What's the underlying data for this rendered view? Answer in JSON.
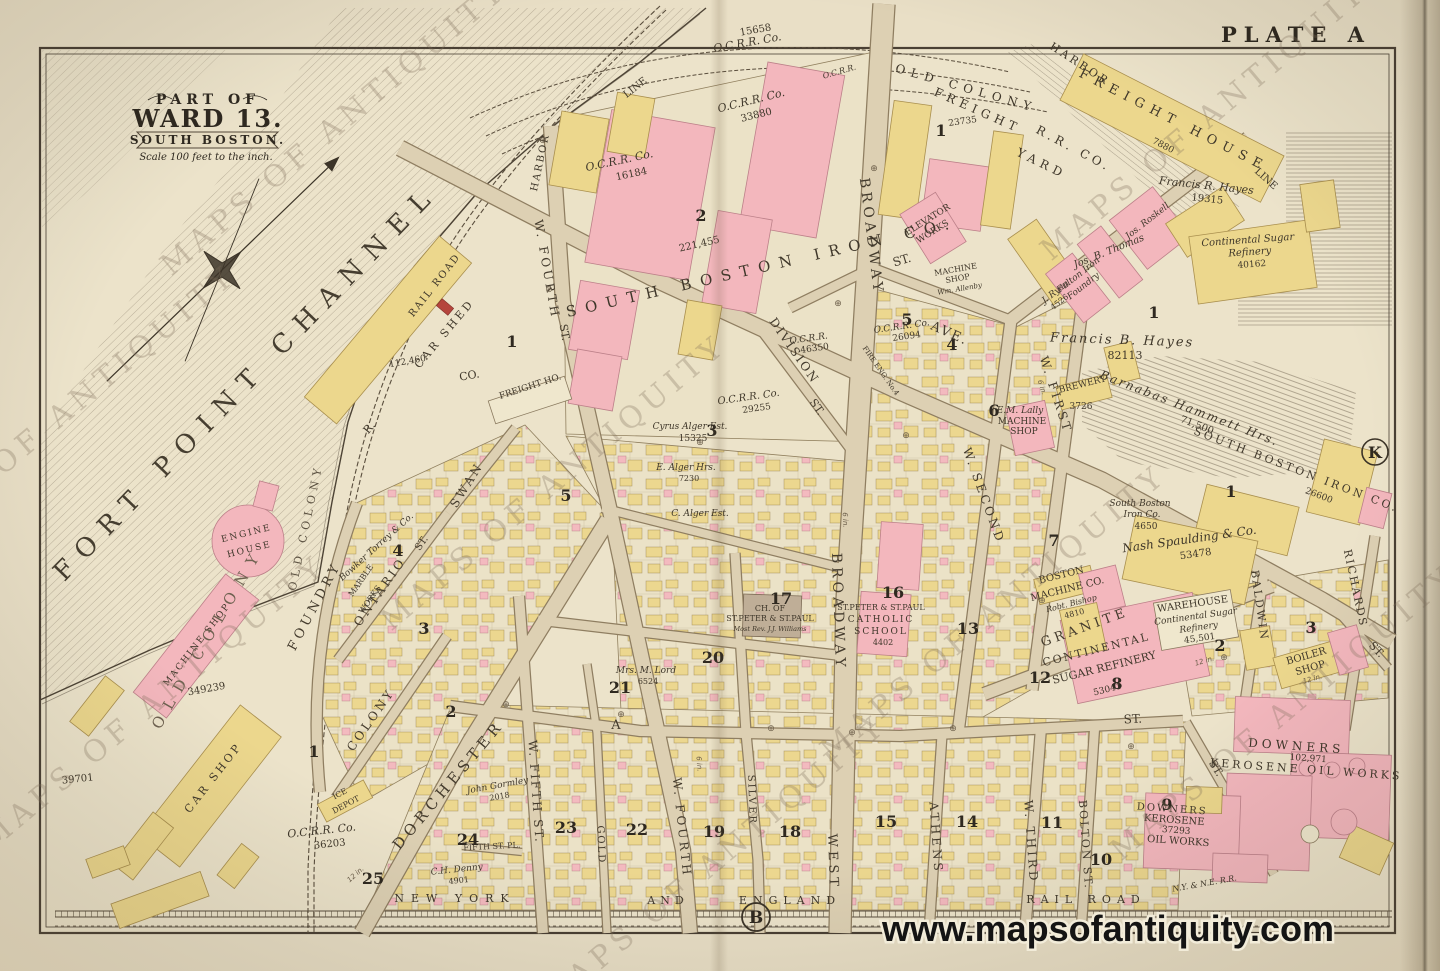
{
  "plate": {
    "label": "PLATE A"
  },
  "branding": {
    "url": "www.mapsofantiquity.com",
    "watermark": "MAPS OF ANTIQUITY"
  },
  "title": {
    "part_of": "PART OF",
    "ward": "WARD 13.",
    "place": "SOUTH BOSTON.",
    "scale": "Scale 100 feet to the inch."
  },
  "water": {
    "channel": "FORT POINT CHANNEL"
  },
  "sections": {
    "b": "B",
    "k": "K"
  },
  "sym": {
    "cross": "⊕"
  },
  "pipes": {
    "six": "6 in.",
    "twelve": "12 in."
  },
  "streets": {
    "foundry": "FOUNDRY",
    "ontario": "ONTARIO",
    "ontario_st": "ST.",
    "swan": "SWAN",
    "colony": "COLONY",
    "dorchester": "DORCHESTER",
    "w_fourth_upper": "W. FOURTH",
    "w_fourth_upper_st": "ST.",
    "w_fourth_lower": "W. FOURTH",
    "broadway_upper": "BROADWAY",
    "broadway_lower": "BROADWAY",
    "west": "WEST",
    "division": "DIVISION",
    "division_st": "ST.",
    "ave": "AVE.",
    "upper_st": "ST.",
    "w_first": "W. FIRST",
    "w_second": "W. SECOND",
    "w_third": "W. THIRD",
    "athens": "ATHENS",
    "bolton": "BOLTON ST.",
    "granite": "GRANITE",
    "baldwin": "BALDWIN",
    "richards": "RICHARDS",
    "w_fifth": "W. FIFTH ST.",
    "gold": "GOLD",
    "silver": "SILVER",
    "a_label": "A",
    "a_st": "ST.",
    "fifth_pl": "FIFTH ST. PL.",
    "st_diag1": "ST.",
    "st_diag2": "ST."
  },
  "railroads": {
    "harbor": "HARBOR",
    "line": "LINE",
    "rail_road": "RAIL ROAD",
    "ocrr_co": "O.C.R.R. Co.",
    "ocrr": "O.C.R.R.",
    "old_colony": "OLD COLONY",
    "freight": "FREIGHT",
    "rr_co": "R.R. CO.",
    "yard": "YARD",
    "freight_house": "FREIGHT HOUSE",
    "new_york": "NEW YORK",
    "and": "AND",
    "england": "ENGLAND",
    "nynerr": "N.Y. & N.E. R.R."
  },
  "numbers": {
    "n15658": "15658",
    "n33880": "33880",
    "n16184": "16184",
    "n23735": "23735",
    "n221455": "221,455",
    "n29255": "29255",
    "n46350": "46350",
    "n26094": "26094",
    "n19315": "19315",
    "n7880": "7880",
    "n40162": "40162",
    "n82113": "82113",
    "n71500": "71,500",
    "n26600": "26600",
    "n4650": "4650",
    "n53478": "53478",
    "n3726": "3726",
    "n4810": "4810",
    "n53041": "53041",
    "n45501": "45,501",
    "n102971": "102,971",
    "n37293": "37293",
    "n15325": "15325",
    "n7230": "7230",
    "n6524": "6524",
    "n2018": "2018",
    "n4901": "4901",
    "n36203": "36203",
    "n39701": "39701",
    "n349239": "349239",
    "n112460": "112,460",
    "n4526": "4526",
    "n4402": "4402"
  },
  "places": {
    "engine_1": "ENGINE",
    "engine_2": "HOUSE",
    "machine_shop": "MACHINE SHOP",
    "car_shop": "CAR SHOP",
    "car_shed": "CAR SHED",
    "car_shed_r": "R.",
    "car_shed_co": "CO.",
    "freight_ho": "FREIGHT HO.",
    "ice_1": "ICE",
    "ice_2": "DEPOT",
    "elevator_1": "ELEVATOR",
    "elevator_2": "WORKS",
    "machine_sm_1": "MACHINE",
    "machine_sm_2": "SHOP",
    "allenby": "Wm. Allenby",
    "fire_eng": "FIRE ENG. No.4",
    "sb_iron_top": "SOUTH BOSTON IRON CO.",
    "sb_iron_right": "SOUTH BOSTON IRON CO.",
    "sb_iron_sm_1": "South Boston",
    "sb_iron_sm_2": "Iron Co.",
    "brewery": "BREWERY",
    "lally_1": "E.M. Lally",
    "lally_2": "MACHINE",
    "lally_3": "SHOP",
    "boston_machine_1": "BOSTON",
    "boston_machine_2": "MACHINE CO.",
    "bishop": "Robt. Bishop",
    "nash": "Nash Spaulding & Co.",
    "continental_1": "CONTINENTAL",
    "continental_2": "SUGAR REFINERY",
    "warehouse_1": "WAREHOUSE",
    "warehouse_2": "Continental Sugar",
    "warehouse_3": "Refinery",
    "boiler_1": "BOILER",
    "boiler_2": "SHOP",
    "downers_1": "DOWNERS",
    "downers_2": "KEROSENE OIL WORKS",
    "downers9_1": "DOWNERS",
    "downers9_2": "KEROSENE",
    "downers9_3": "OIL WORKS",
    "church_1": "CH. OF",
    "church_2": "ST.PETER & ST.PAUL",
    "church_3": "Most Rev. J.J. Williams",
    "school_1": "ST.PETER & ST.PAUL",
    "school_2": "CATHOLIC",
    "school_3": "SCHOOL",
    "sugar_top_1": "Continental Sugar",
    "sugar_top_2": "Refinery",
    "bowker": "Bowker Torrey & Co.",
    "marble_1": "MARBLE",
    "marble_2": "WORKS",
    "fulton_1": "Fulton Iron",
    "fulton_2": "Foundry"
  },
  "owners": {
    "hayes_r": "Francis R. Hayes",
    "hayes_b": "Francis B. Hayes",
    "hammett": "Barnabas Hammett Hrs.",
    "thomas": "Jos. B. Thomas",
    "roskell": "Jos. Roskell",
    "ryan": "J. Ryan",
    "alger_cyrus": "Cyrus Alger Est.",
    "alger_e": "E. Alger Hrs.",
    "alger_c": "C. Alger Est.",
    "lord": "Mrs. M. Lord",
    "gormley": "John Gormley",
    "denny": "C.H. Denny",
    "old_colony_estate": "OLD COLONY"
  },
  "blocks": {
    "n1": "1",
    "n2": "2",
    "n3": "3",
    "n4": "4",
    "n5": "5",
    "n6": "6",
    "n7": "7",
    "n8": "8",
    "n9": "9",
    "n10": "10",
    "n11": "11",
    "n12": "12",
    "n13": "13",
    "n14": "14",
    "n15": "15",
    "n16": "16",
    "n17": "17",
    "n18": "18",
    "n19": "19",
    "n20": "20",
    "n21": "21",
    "n22": "22",
    "n23": "23",
    "n24": "24",
    "n25": "25"
  }
}
